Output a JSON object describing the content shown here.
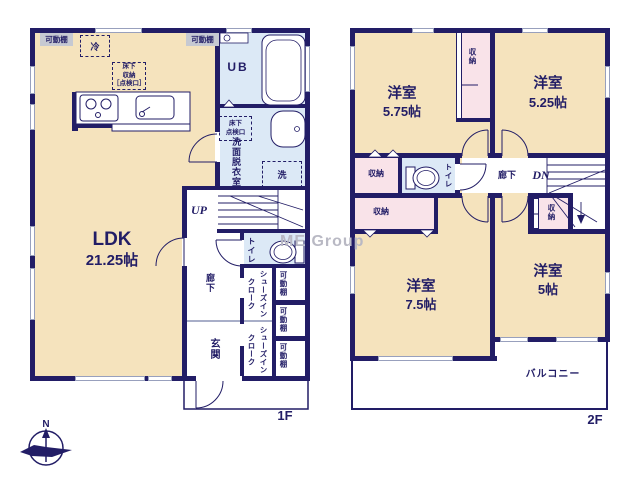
{
  "palette": {
    "wall_color": "#221d66",
    "room_beige": "#f5e3bd",
    "closet_pink": "#f9e3e9",
    "wet_area_blue": "#dce9f6",
    "shelf_gray": "#c6c9d2",
    "watermark_gray": "#b9b9c4"
  },
  "watermark_text": "ME Group",
  "compass": {
    "north_label": "N"
  },
  "floor1": {
    "floor_label": "1F",
    "ldk_name": "LDK",
    "ldk_size": "21.25帖",
    "ub_label": "UB",
    "washroom_label": "洗面脱衣室",
    "toilet_label": "トイレ",
    "hallway_label": "廊下",
    "entrance_label": "玄関",
    "sic_label": "シューズインクローク",
    "shelf_label": "可動棚",
    "fridge_label": "冷",
    "washer_label": "洗",
    "underfloor_storage_label": "床下\n収納\n［点検口］",
    "underfloor_access_label": "床下\n点検口",
    "up_label": "UP"
  },
  "floor2": {
    "floor_label": "2F",
    "bedroom1_name": "洋室",
    "bedroom1_size": "5.75帖",
    "bedroom2_name": "洋室",
    "bedroom2_size": "5.25帖",
    "bedroom3_name": "洋室",
    "bedroom3_size": "7.5帖",
    "bedroom4_name": "洋室",
    "bedroom4_size": "5帖",
    "storage_label": "収納",
    "toilet_label": "トイレ",
    "hallway_label": "廊下",
    "dn_label": "DN",
    "balcony_label": "バルコニー"
  }
}
